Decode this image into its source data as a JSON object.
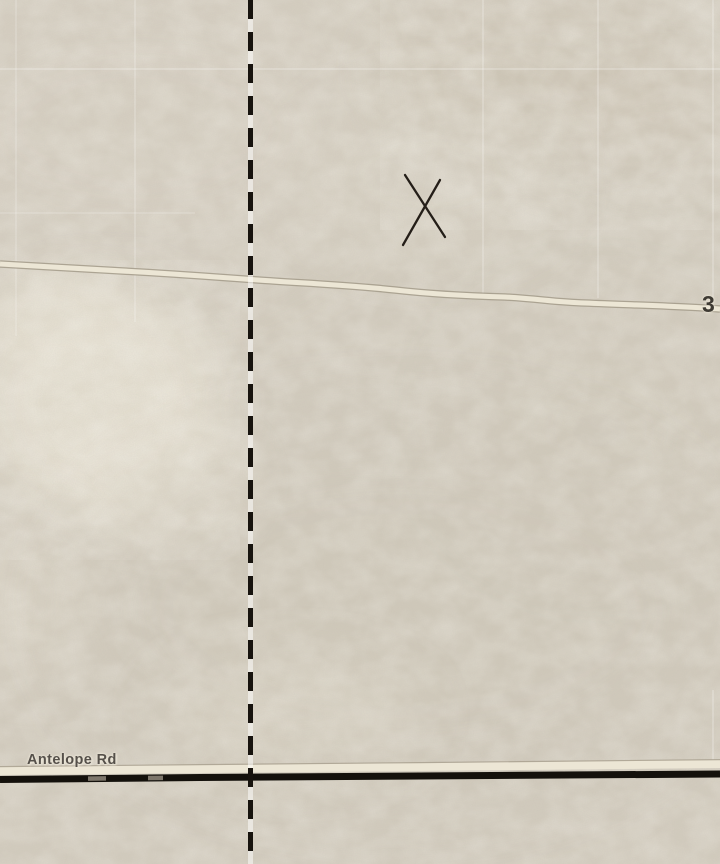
{
  "map": {
    "view_type": "satellite-map-tile",
    "road_label": "Antelope Rd",
    "route_number": "3",
    "annotation": {
      "symbol": "X",
      "center_x": 424,
      "center_y": 209
    },
    "boundary": {
      "style": "dashed",
      "orientation": "vertical",
      "position_x": 250
    },
    "colors": {
      "terrain_base": "#d3ccbe",
      "terrain_light": "#e8e2d3",
      "terrain_dark": "#c9c0af",
      "minor_road_fill": "#ece6d5",
      "minor_road_casing": "#a39b89",
      "major_road": "#14110c",
      "boundary_line": "#17130e",
      "label_text": "#55504a",
      "grid_line": "#ffffff"
    }
  }
}
